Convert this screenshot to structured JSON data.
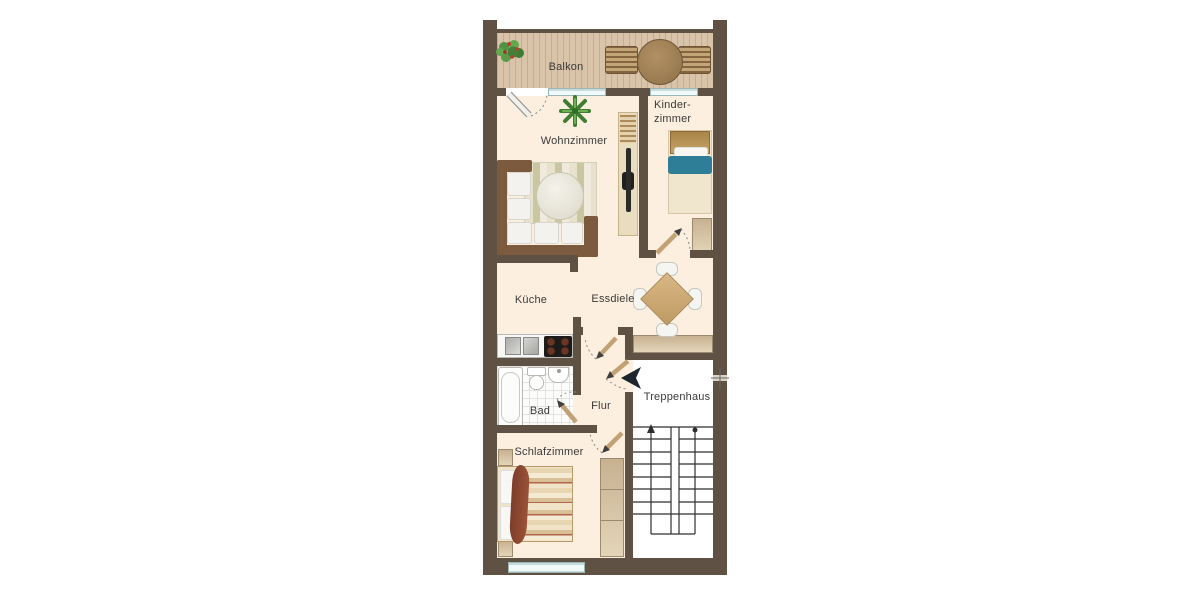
{
  "plan": {
    "rooms": {
      "balkon": "Balkon",
      "wohnzimmer": "Wohnzimmer",
      "kinderzimmer_line1": "Kinder-",
      "kinderzimmer_line2": "zimmer",
      "kueche": "Küche",
      "essdiele": "Essdiele",
      "bad": "Bad",
      "flur": "Flur",
      "treppenhaus": "Treppenhaus",
      "schlafzimmer": "Schlafzimmer"
    },
    "colors": {
      "wall": "#5f5244",
      "floor": "#fcefdf",
      "balcony-wood": "#d9c4a9",
      "window": "#e9f5f5",
      "stair-floor": "#ffffff",
      "furniture-beige": "#e2d0ae",
      "sofa-frame": "#7b5a3d",
      "cushion": "#f3f2ef",
      "teal": "#2e7e97",
      "table-tan": "#cda672",
      "door-leaf": "#c2a274",
      "arrow-dark": "#1c262c",
      "label": "#3a3a3a"
    }
  }
}
